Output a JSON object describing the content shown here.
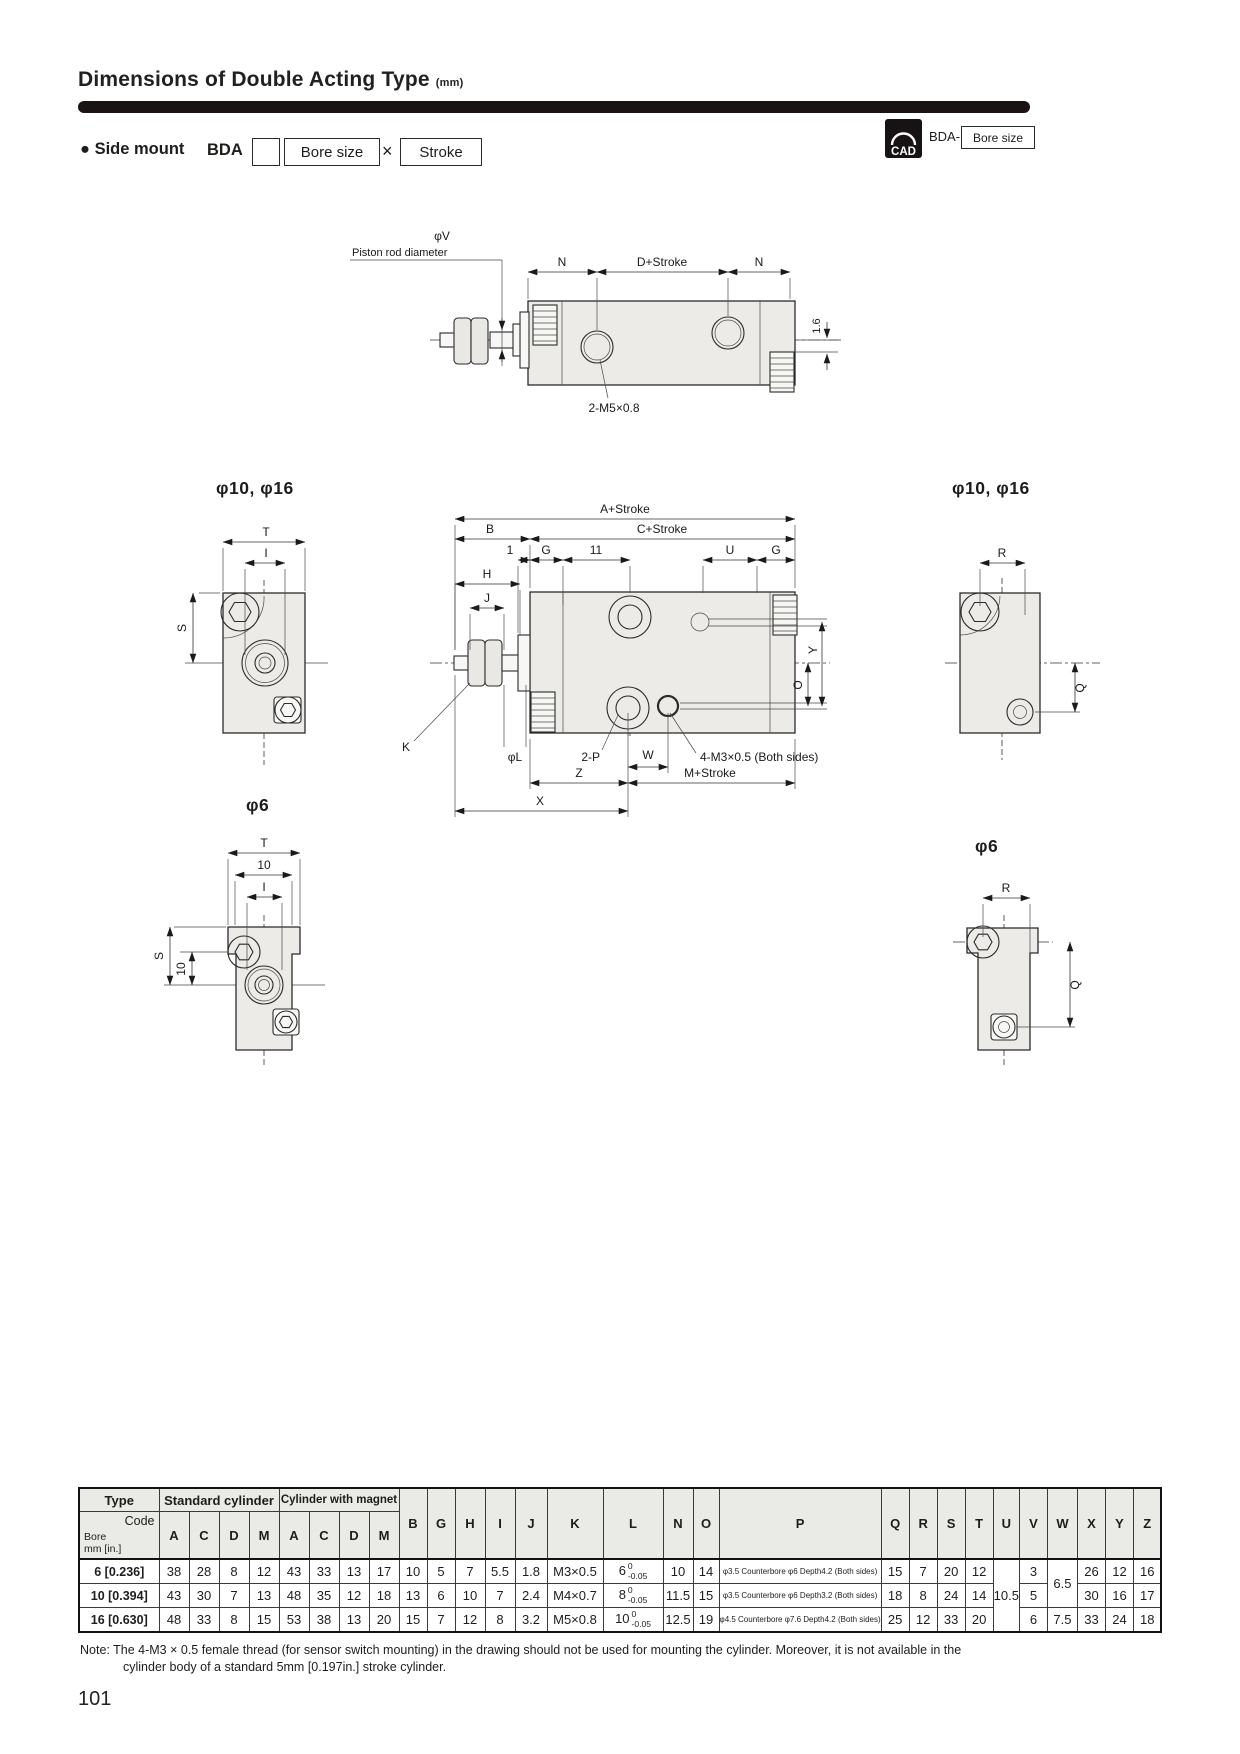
{
  "page": {
    "title": "Dimensions of Double Acting Type",
    "unit": "(mm)",
    "page_number": "101"
  },
  "header": {
    "bullet": "●",
    "label": "Side mount",
    "model": "BDA",
    "bore_box": "Bore size",
    "times": "×",
    "stroke_box": "Stroke",
    "cad": "CAD",
    "cad_prefix": "BDA-",
    "cad_bore_box": "Bore size"
  },
  "drawings": {
    "titles": {
      "front_large": "φ10, φ16",
      "right_large": "φ10, φ16",
      "front_small": "φ6",
      "right_small": "φ6"
    },
    "top": {
      "phi_v": "φV",
      "piston_rod": "Piston rod diameter",
      "n1": "N",
      "d_stroke": "D+Stroke",
      "n2": "N",
      "offset": "1.6",
      "port": "2-M5×0.8"
    },
    "front_large": {
      "t": "T",
      "i": "I",
      "s": "S"
    },
    "side": {
      "a": "A+Stroke",
      "b": "B",
      "c": "C+Stroke",
      "one": "1",
      "g1": "G",
      "eleven": "11",
      "u": "U",
      "g2": "G",
      "h": "H",
      "j": "J",
      "k": "K",
      "phi_l": "φL",
      "two_p": "2-P",
      "w": "W",
      "sensor": "4-M3×0.5 (Both sides)",
      "z": "Z",
      "m": "M+Stroke",
      "x": "X",
      "o": "O",
      "y": "Y"
    },
    "right_large": {
      "r": "R",
      "q": "Q"
    },
    "front_small": {
      "t": "T",
      "ten_h": "10",
      "i": "I",
      "s": "S",
      "ten_v": "10"
    },
    "right_small": {
      "r": "R",
      "q": "Q"
    }
  },
  "table": {
    "corner": {
      "type": "Type",
      "code": "Code",
      "bore": "Bore",
      "bore_unit": "mm [in.]"
    },
    "groups": {
      "standard": "Standard cylinder",
      "magnet": "Cylinder with magnet"
    },
    "subcols": [
      "A",
      "C",
      "D",
      "M",
      "A",
      "C",
      "D",
      "M"
    ],
    "cols": [
      "B",
      "G",
      "H",
      "I",
      "J",
      "K",
      "L",
      "N",
      "O",
      "P",
      "Q",
      "R",
      "S",
      "T",
      "U",
      "V",
      "W",
      "X",
      "Y",
      "Z"
    ],
    "tol": {
      "top": "0",
      "bottom": "-0.05"
    },
    "merged": {
      "u": "10.5",
      "w12": "6.5",
      "w3": "7.5"
    },
    "rows": [
      {
        "bore": "6 [0.236]",
        "a1": "38",
        "c1": "28",
        "d1": "8",
        "m1": "12",
        "a2": "43",
        "c2": "33",
        "d2": "13",
        "m2": "17",
        "b": "10",
        "g": "5",
        "h": "7",
        "i": "5.5",
        "j": "1.8",
        "k": "M3×0.5",
        "l": "6",
        "n": "10",
        "o": "14",
        "p": "φ3.5 Counterbore φ6  Depth4.2 (Both sides)",
        "q": "15",
        "r": "7",
        "s": "20",
        "t": "12",
        "v": "3",
        "x": "26",
        "y": "12",
        "z": "16"
      },
      {
        "bore": "10 [0.394]",
        "a1": "43",
        "c1": "30",
        "d1": "7",
        "m1": "13",
        "a2": "48",
        "c2": "35",
        "d2": "12",
        "m2": "18",
        "b": "13",
        "g": "6",
        "h": "10",
        "i": "7",
        "j": "2.4",
        "k": "M4×0.7",
        "l": "8",
        "n": "11.5",
        "o": "15",
        "p": "φ3.5 Counterbore φ6  Depth3.2 (Both sides)",
        "q": "18",
        "r": "8",
        "s": "24",
        "t": "14",
        "v": "5",
        "x": "30",
        "y": "16",
        "z": "17"
      },
      {
        "bore": "16 [0.630]",
        "a1": "48",
        "c1": "33",
        "d1": "8",
        "m1": "15",
        "a2": "53",
        "c2": "38",
        "d2": "13",
        "m2": "20",
        "b": "15",
        "g": "7",
        "h": "12",
        "i": "8",
        "j": "3.2",
        "k": "M5×0.8",
        "l": "10",
        "n": "12.5",
        "o": "19",
        "p": "φ4.5 Counterbore φ7.6  Depth4.2 (Both sides)",
        "q": "25",
        "r": "12",
        "s": "33",
        "t": "20",
        "v": "6",
        "x": "33",
        "y": "24",
        "z": "18"
      }
    ]
  },
  "note": {
    "label": "Note:",
    "line1": "The 4-M3 × 0.5 female thread (for sensor switch mounting) in the drawing should not be used for mounting the cylinder. Moreover, it is not available in the",
    "line2": "cylinder body of a standard 5mm [0.197in.] stroke cylinder."
  }
}
